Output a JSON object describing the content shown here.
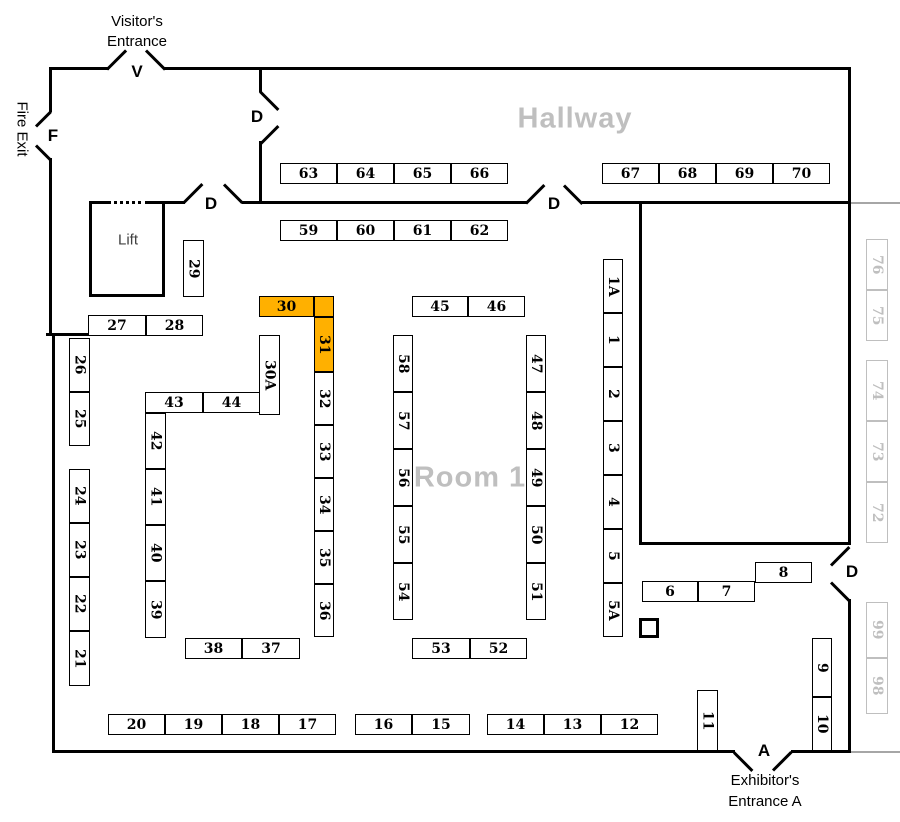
{
  "colors": {
    "highlight": "#FFB000",
    "muted_booth": "#BFBFBF",
    "muted_line": "#A6A6A6",
    "wall": "#000000",
    "room_label": "#BFBFBF"
  },
  "labels": {
    "visitor_entrance_line1": "Visitor's",
    "visitor_entrance_line2": "Entrance",
    "fire_exit": "Fire Exit",
    "exhibitor_entrance_line1": "Exhibitor's",
    "exhibitor_entrance_line2": "Entrance A",
    "hallway": "Hallway",
    "room1": "Room 1",
    "lift": "Lift"
  },
  "doors": [
    {
      "label": "V",
      "x": 137,
      "y": 72
    },
    {
      "label": "F",
      "x": 53,
      "y": 136
    },
    {
      "label": "D",
      "x": 257,
      "y": 117
    },
    {
      "label": "D",
      "x": 211,
      "y": 204
    },
    {
      "label": "D",
      "x": 554,
      "y": 204
    },
    {
      "label": "D",
      "x": 852,
      "y": 572
    },
    {
      "label": "A",
      "x": 764,
      "y": 751
    }
  ],
  "booths": [
    {
      "label": "63",
      "x": 280,
      "y": 163,
      "w": 57,
      "h": 21,
      "o": "h",
      "t": "std"
    },
    {
      "label": "64",
      "x": 337,
      "y": 163,
      "w": 57,
      "h": 21,
      "o": "h",
      "t": "std"
    },
    {
      "label": "65",
      "x": 394,
      "y": 163,
      "w": 57,
      "h": 21,
      "o": "h",
      "t": "std"
    },
    {
      "label": "66",
      "x": 451,
      "y": 163,
      "w": 57,
      "h": 21,
      "o": "h",
      "t": "std"
    },
    {
      "label": "67",
      "x": 602,
      "y": 163,
      "w": 57,
      "h": 21,
      "o": "h",
      "t": "std"
    },
    {
      "label": "68",
      "x": 659,
      "y": 163,
      "w": 57,
      "h": 21,
      "o": "h",
      "t": "std"
    },
    {
      "label": "69",
      "x": 716,
      "y": 163,
      "w": 57,
      "h": 21,
      "o": "h",
      "t": "std"
    },
    {
      "label": "70",
      "x": 773,
      "y": 163,
      "w": 57,
      "h": 21,
      "o": "h",
      "t": "std"
    },
    {
      "label": "59",
      "x": 280,
      "y": 220,
      "w": 57,
      "h": 21,
      "o": "h",
      "t": "std"
    },
    {
      "label": "60",
      "x": 337,
      "y": 220,
      "w": 57,
      "h": 21,
      "o": "h",
      "t": "std"
    },
    {
      "label": "61",
      "x": 394,
      "y": 220,
      "w": 57,
      "h": 21,
      "o": "h",
      "t": "std"
    },
    {
      "label": "62",
      "x": 451,
      "y": 220,
      "w": 57,
      "h": 21,
      "o": "h",
      "t": "std"
    },
    {
      "label": "45",
      "x": 412,
      "y": 296,
      "w": 56,
      "h": 21,
      "o": "h",
      "t": "std"
    },
    {
      "label": "46",
      "x": 468,
      "y": 296,
      "w": 57,
      "h": 21,
      "o": "h",
      "t": "std"
    },
    {
      "label": "30",
      "x": 259,
      "y": 296,
      "w": 55,
      "h": 21,
      "o": "h",
      "t": "hl"
    },
    {
      "label": "",
      "x": 314,
      "y": 296,
      "w": 20,
      "h": 21,
      "o": "h",
      "t": "hl"
    },
    {
      "label": "31",
      "x": 314,
      "y": 317,
      "w": 20,
      "h": 55,
      "o": "v",
      "t": "hl"
    },
    {
      "label": "27",
      "x": 88,
      "y": 315,
      "w": 58,
      "h": 21,
      "o": "h",
      "t": "std"
    },
    {
      "label": "28",
      "x": 146,
      "y": 315,
      "w": 57,
      "h": 21,
      "o": "h",
      "t": "std"
    },
    {
      "label": "29",
      "x": 183,
      "y": 240,
      "w": 21,
      "h": 57,
      "o": "v",
      "t": "std"
    },
    {
      "label": "30A",
      "x": 259,
      "y": 335,
      "w": 21,
      "h": 80,
      "o": "v",
      "t": "std"
    },
    {
      "label": "32",
      "x": 314,
      "y": 372,
      "w": 20,
      "h": 53,
      "o": "v",
      "t": "std"
    },
    {
      "label": "33",
      "x": 314,
      "y": 425,
      "w": 20,
      "h": 53,
      "o": "v",
      "t": "std"
    },
    {
      "label": "34",
      "x": 314,
      "y": 478,
      "w": 20,
      "h": 53,
      "o": "v",
      "t": "std"
    },
    {
      "label": "35",
      "x": 314,
      "y": 531,
      "w": 20,
      "h": 53,
      "o": "v",
      "t": "std"
    },
    {
      "label": "36",
      "x": 314,
      "y": 584,
      "w": 20,
      "h": 53,
      "o": "v",
      "t": "std"
    },
    {
      "label": "43",
      "x": 145,
      "y": 392,
      "w": 58,
      "h": 21,
      "o": "h",
      "t": "std"
    },
    {
      "label": "44",
      "x": 203,
      "y": 392,
      "w": 57,
      "h": 21,
      "o": "h",
      "t": "std"
    },
    {
      "label": "42",
      "x": 145,
      "y": 413,
      "w": 21,
      "h": 56,
      "o": "v",
      "t": "std"
    },
    {
      "label": "41",
      "x": 145,
      "y": 469,
      "w": 21,
      "h": 56,
      "o": "v",
      "t": "std"
    },
    {
      "label": "40",
      "x": 145,
      "y": 525,
      "w": 21,
      "h": 56,
      "o": "v",
      "t": "std"
    },
    {
      "label": "39",
      "x": 145,
      "y": 581,
      "w": 21,
      "h": 57,
      "o": "v",
      "t": "std"
    },
    {
      "label": "26",
      "x": 69,
      "y": 338,
      "w": 21,
      "h": 54,
      "o": "v",
      "t": "std"
    },
    {
      "label": "25",
      "x": 69,
      "y": 392,
      "w": 21,
      "h": 54,
      "o": "v",
      "t": "std"
    },
    {
      "label": "24",
      "x": 69,
      "y": 469,
      "w": 21,
      "h": 54,
      "o": "v",
      "t": "std"
    },
    {
      "label": "23",
      "x": 69,
      "y": 523,
      "w": 21,
      "h": 54,
      "o": "v",
      "t": "std"
    },
    {
      "label": "22",
      "x": 69,
      "y": 577,
      "w": 21,
      "h": 54,
      "o": "v",
      "t": "std"
    },
    {
      "label": "21",
      "x": 69,
      "y": 631,
      "w": 21,
      "h": 55,
      "o": "v",
      "t": "std"
    },
    {
      "label": "58",
      "x": 393,
      "y": 335,
      "w": 20,
      "h": 57,
      "o": "v",
      "t": "std"
    },
    {
      "label": "57",
      "x": 393,
      "y": 392,
      "w": 20,
      "h": 57,
      "o": "v",
      "t": "std"
    },
    {
      "label": "56",
      "x": 393,
      "y": 449,
      "w": 20,
      "h": 57,
      "o": "v",
      "t": "std"
    },
    {
      "label": "55",
      "x": 393,
      "y": 506,
      "w": 20,
      "h": 57,
      "o": "v",
      "t": "std"
    },
    {
      "label": "54",
      "x": 393,
      "y": 563,
      "w": 20,
      "h": 57,
      "o": "v",
      "t": "std"
    },
    {
      "label": "47",
      "x": 526,
      "y": 335,
      "w": 20,
      "h": 57,
      "o": "v",
      "t": "std"
    },
    {
      "label": "48",
      "x": 526,
      "y": 392,
      "w": 20,
      "h": 57,
      "o": "v",
      "t": "std"
    },
    {
      "label": "49",
      "x": 526,
      "y": 449,
      "w": 20,
      "h": 57,
      "o": "v",
      "t": "std"
    },
    {
      "label": "50",
      "x": 526,
      "y": 506,
      "w": 20,
      "h": 57,
      "o": "v",
      "t": "std"
    },
    {
      "label": "51",
      "x": 526,
      "y": 563,
      "w": 20,
      "h": 57,
      "o": "v",
      "t": "std"
    },
    {
      "label": "1A",
      "x": 603,
      "y": 259,
      "w": 20,
      "h": 54,
      "o": "v",
      "t": "std"
    },
    {
      "label": "1",
      "x": 603,
      "y": 313,
      "w": 20,
      "h": 54,
      "o": "v",
      "t": "std"
    },
    {
      "label": "2",
      "x": 603,
      "y": 367,
      "w": 20,
      "h": 54,
      "o": "v",
      "t": "std"
    },
    {
      "label": "3",
      "x": 603,
      "y": 421,
      "w": 20,
      "h": 54,
      "o": "v",
      "t": "std"
    },
    {
      "label": "4",
      "x": 603,
      "y": 475,
      "w": 20,
      "h": 54,
      "o": "v",
      "t": "std"
    },
    {
      "label": "5",
      "x": 603,
      "y": 529,
      "w": 20,
      "h": 54,
      "o": "v",
      "t": "std"
    },
    {
      "label": "5A",
      "x": 603,
      "y": 583,
      "w": 20,
      "h": 54,
      "o": "v",
      "t": "std"
    },
    {
      "label": "6",
      "x": 642,
      "y": 581,
      "w": 56,
      "h": 21,
      "o": "h",
      "t": "std"
    },
    {
      "label": "7",
      "x": 698,
      "y": 581,
      "w": 57,
      "h": 21,
      "o": "h",
      "t": "std"
    },
    {
      "label": "8",
      "x": 755,
      "y": 562,
      "w": 57,
      "h": 21,
      "o": "h",
      "t": "std"
    },
    {
      "label": "38",
      "x": 185,
      "y": 638,
      "w": 57,
      "h": 21,
      "o": "h",
      "t": "std"
    },
    {
      "label": "37",
      "x": 242,
      "y": 638,
      "w": 58,
      "h": 21,
      "o": "h",
      "t": "std"
    },
    {
      "label": "53",
      "x": 412,
      "y": 638,
      "w": 58,
      "h": 21,
      "o": "h",
      "t": "std"
    },
    {
      "label": "52",
      "x": 470,
      "y": 638,
      "w": 57,
      "h": 21,
      "o": "h",
      "t": "std"
    },
    {
      "label": "9",
      "x": 812,
      "y": 638,
      "w": 20,
      "h": 59,
      "o": "v",
      "t": "std"
    },
    {
      "label": "10",
      "x": 812,
      "y": 697,
      "w": 20,
      "h": 54,
      "o": "v",
      "t": "std"
    },
    {
      "label": "11",
      "x": 697,
      "y": 690,
      "w": 21,
      "h": 61,
      "o": "v",
      "t": "std"
    },
    {
      "label": "20",
      "x": 108,
      "y": 714,
      "w": 57,
      "h": 21,
      "o": "h",
      "t": "std"
    },
    {
      "label": "19",
      "x": 165,
      "y": 714,
      "w": 57,
      "h": 21,
      "o": "h",
      "t": "std"
    },
    {
      "label": "18",
      "x": 222,
      "y": 714,
      "w": 57,
      "h": 21,
      "o": "h",
      "t": "std"
    },
    {
      "label": "17",
      "x": 279,
      "y": 714,
      "w": 57,
      "h": 21,
      "o": "h",
      "t": "std"
    },
    {
      "label": "16",
      "x": 355,
      "y": 714,
      "w": 57,
      "h": 21,
      "o": "h",
      "t": "std"
    },
    {
      "label": "15",
      "x": 412,
      "y": 714,
      "w": 58,
      "h": 21,
      "o": "h",
      "t": "std"
    },
    {
      "label": "14",
      "x": 487,
      "y": 714,
      "w": 57,
      "h": 21,
      "o": "h",
      "t": "std"
    },
    {
      "label": "13",
      "x": 544,
      "y": 714,
      "w": 57,
      "h": 21,
      "o": "h",
      "t": "std"
    },
    {
      "label": "12",
      "x": 601,
      "y": 714,
      "w": 57,
      "h": 21,
      "o": "h",
      "t": "std"
    },
    {
      "label": "76",
      "x": 866,
      "y": 239,
      "w": 22,
      "h": 51,
      "o": "v",
      "t": "out"
    },
    {
      "label": "75",
      "x": 866,
      "y": 290,
      "w": 22,
      "h": 51,
      "o": "v",
      "t": "out"
    },
    {
      "label": "74",
      "x": 866,
      "y": 360,
      "w": 22,
      "h": 61,
      "o": "v",
      "t": "out"
    },
    {
      "label": "73",
      "x": 866,
      "y": 421,
      "w": 22,
      "h": 61,
      "o": "v",
      "t": "out"
    },
    {
      "label": "72",
      "x": 866,
      "y": 482,
      "w": 22,
      "h": 61,
      "o": "v",
      "t": "out"
    },
    {
      "label": "99",
      "x": 866,
      "y": 602,
      "w": 22,
      "h": 56,
      "o": "v",
      "t": "out"
    },
    {
      "label": "98",
      "x": 866,
      "y": 658,
      "w": 22,
      "h": 56,
      "o": "v",
      "t": "out"
    }
  ]
}
